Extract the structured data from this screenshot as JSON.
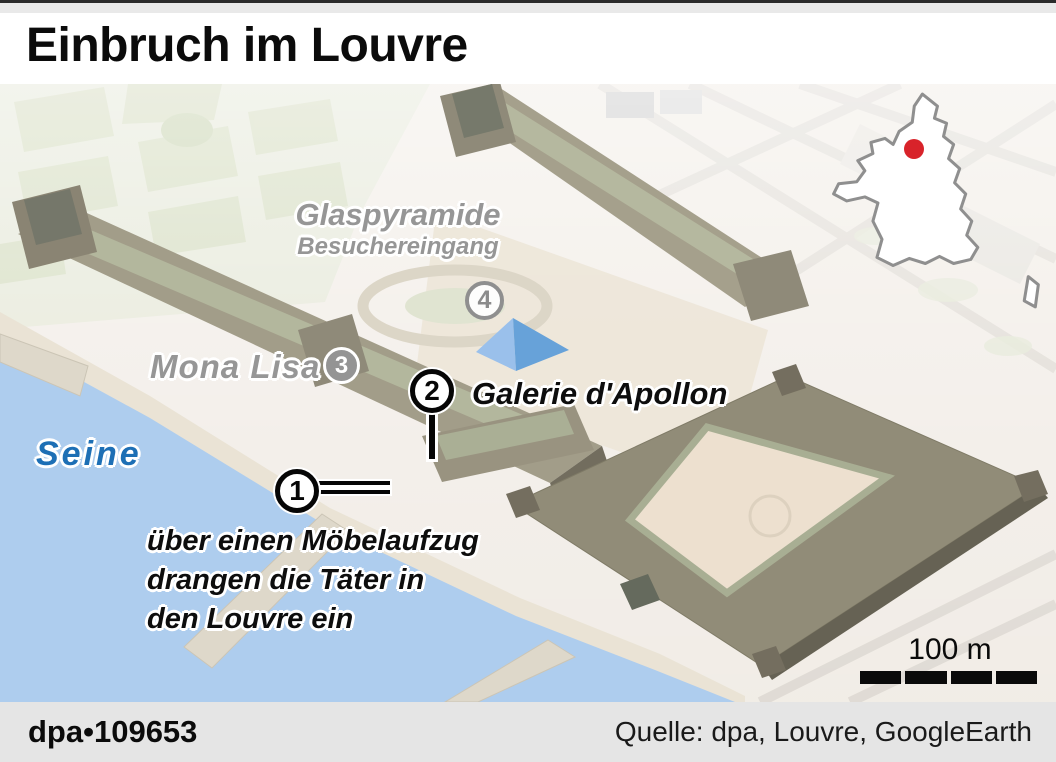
{
  "header": {
    "title": "Einbruch im Louvre"
  },
  "map": {
    "labels": {
      "glaspyramide": "Glaspyramide",
      "besuchereingang": "Besuchereingang",
      "mona_lisa": "Mona Lisa",
      "galerie_apollon": "Galerie d'Apollon",
      "seine": "Seine"
    },
    "annotation_lines": [
      "über einen Möbelaufzug",
      "drangen die Täter in",
      "den Louvre ein"
    ],
    "markers": [
      {
        "number": "1"
      },
      {
        "number": "2"
      },
      {
        "number": "3"
      },
      {
        "number": "4"
      }
    ],
    "scale_bar": {
      "label": "100 m"
    },
    "inset": {
      "label": "PARIS"
    }
  },
  "footer": {
    "credit": "dpa•109653",
    "source": "Quelle: dpa, Louvre, GoogleEarth"
  },
  "colors": {
    "seine_label_blue": "#1d6fb5",
    "map_label_gray": "#969696",
    "pyramid_blue_light": "#95bdea",
    "pyramid_blue_dark": "#5f9ed7",
    "water": "#aacbee",
    "paris_dot_red": "#d8232a",
    "footer_bg": "#e5e5e5"
  }
}
